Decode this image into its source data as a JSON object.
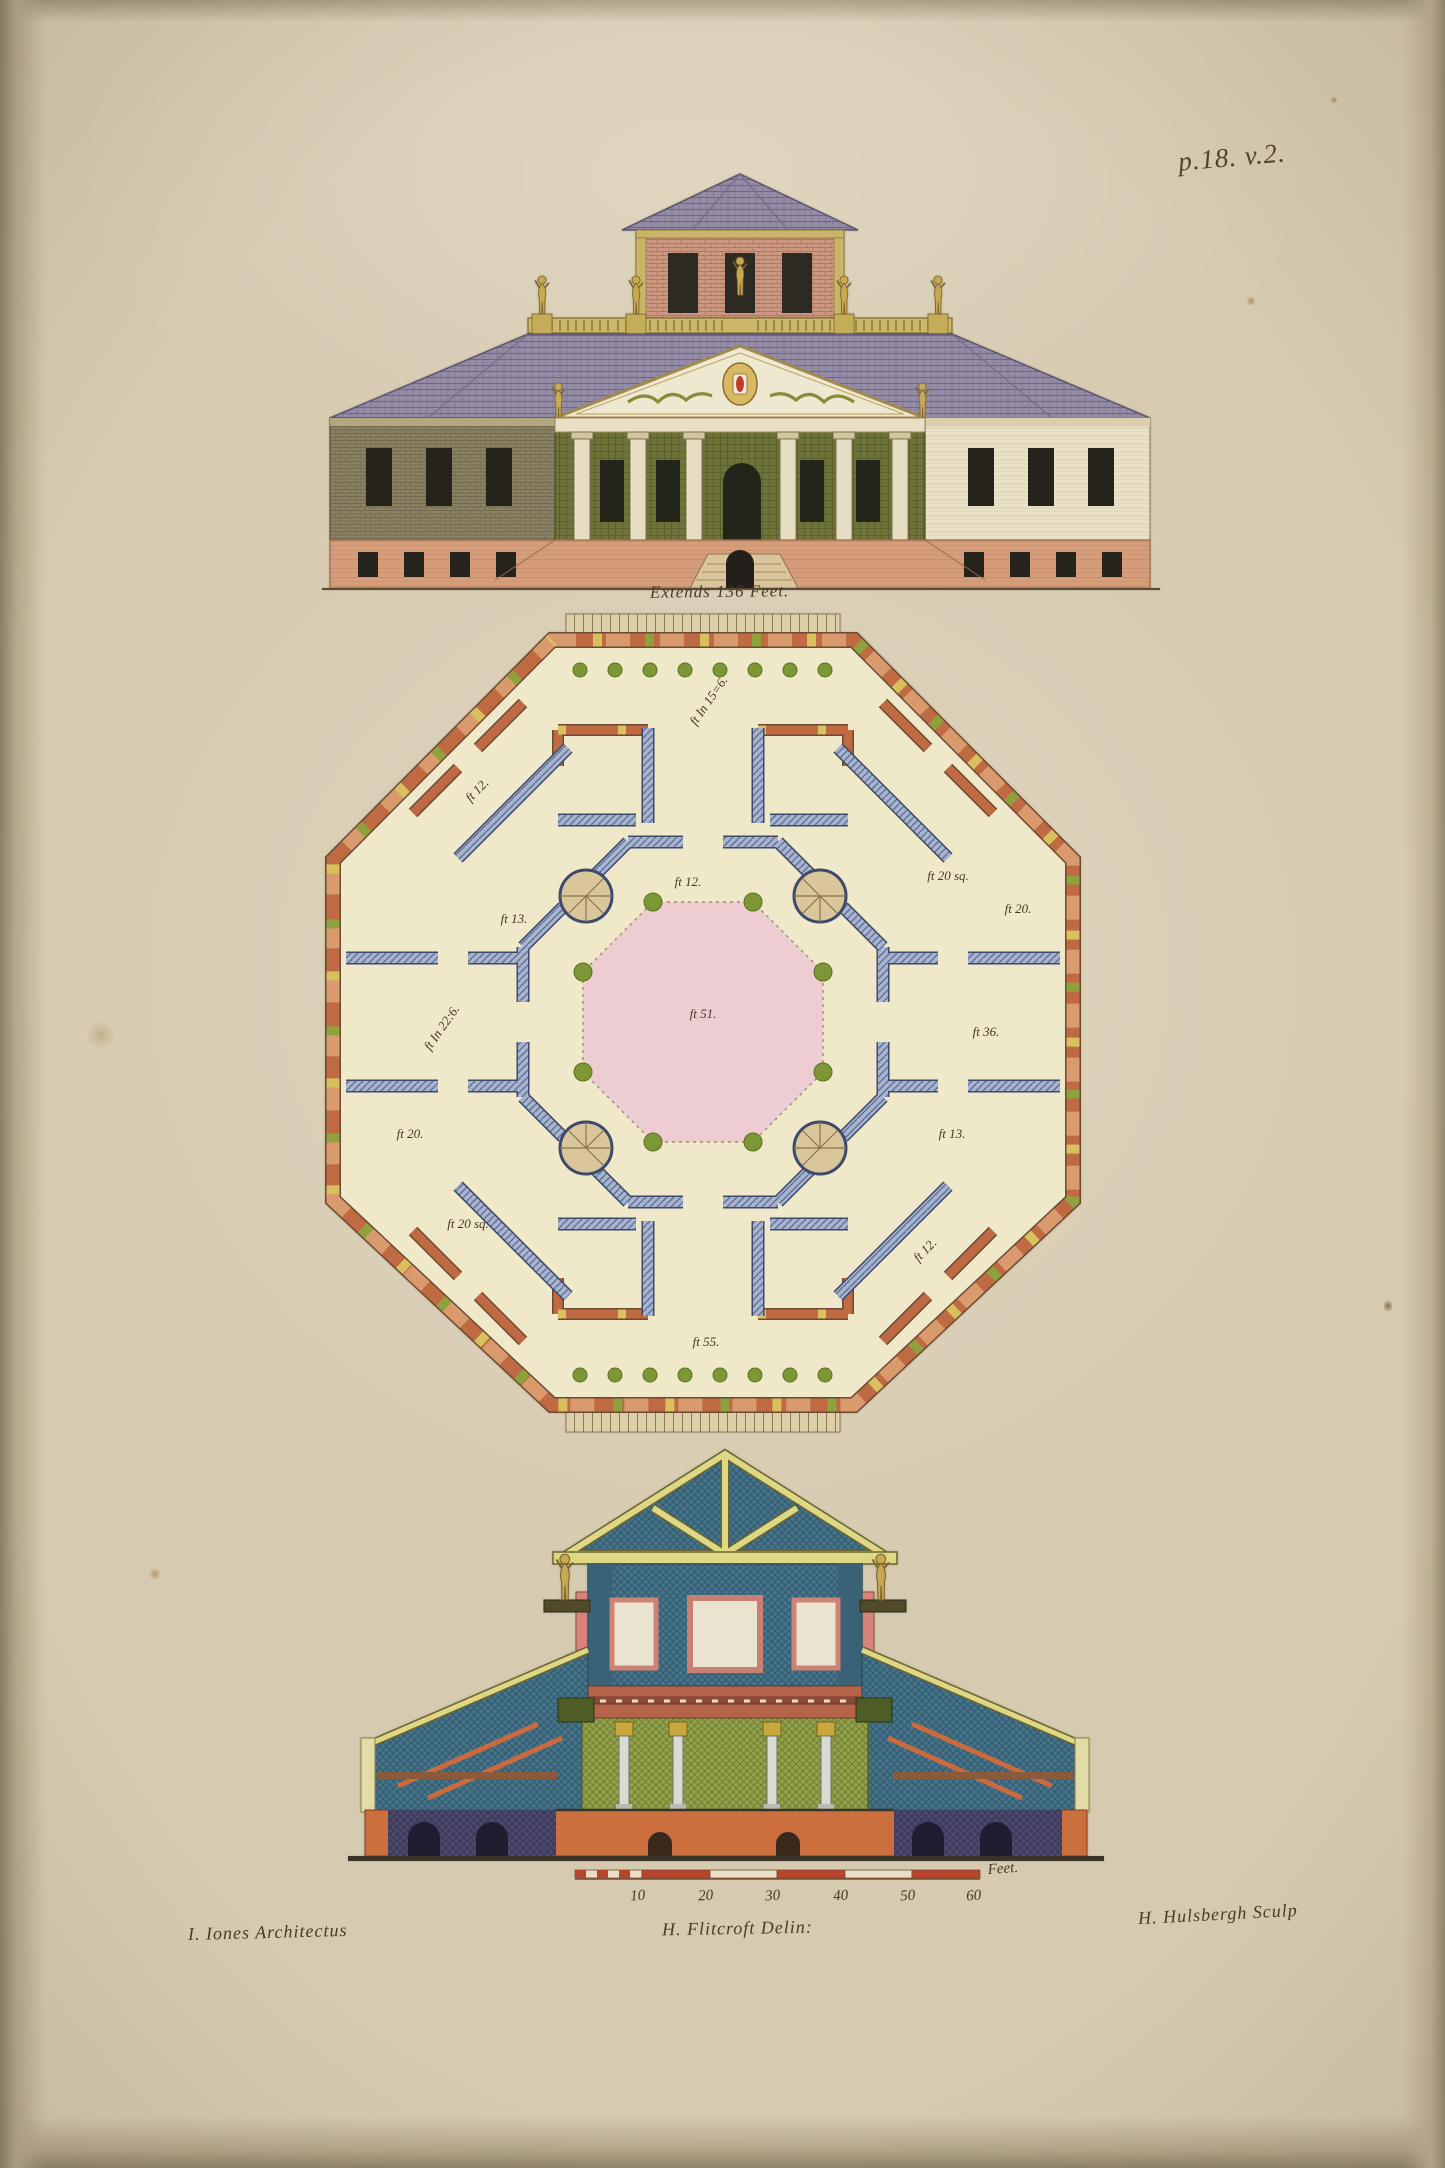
{
  "page": {
    "number": "p.18. v.2."
  },
  "elevation": {
    "caption": "Extends 136 Feet."
  },
  "plan": {
    "labels": [
      {
        "name": "north-vestibule",
        "text": "ft In 15=6."
      },
      {
        "name": "north-west-room",
        "text": "ft 12."
      },
      {
        "name": "north-east-room",
        "text": "ft 20 sq."
      },
      {
        "name": "northwest-gallery",
        "text": "ft 12."
      },
      {
        "name": "west-upper-room",
        "text": "ft 13."
      },
      {
        "name": "west-room",
        "text": "ft In 22:6."
      },
      {
        "name": "east-upper-room",
        "text": "ft 20."
      },
      {
        "name": "east-room",
        "text": "ft 36."
      },
      {
        "name": "central-hall",
        "text": "ft 51."
      },
      {
        "name": "west-lower-room",
        "text": "ft 20."
      },
      {
        "name": "east-lower-room",
        "text": "ft 13."
      },
      {
        "name": "south-west-room",
        "text": "ft 20 sq."
      },
      {
        "name": "southeast-gallery",
        "text": "ft 12."
      },
      {
        "name": "south-vestibule",
        "text": "ft 55."
      }
    ]
  },
  "scale_bar": {
    "ticks": [
      "10",
      "20",
      "30",
      "40",
      "50",
      "60"
    ],
    "unit": "Feet."
  },
  "credits": {
    "architect": "I. Iones Architectus",
    "draughtsman": "H. Flitcroft Delin:",
    "engraver": "H. Hulsbergh Sculp"
  },
  "colors": {
    "paper": "#d6cab0",
    "ink": "#4a3b28",
    "roof_slate": "#948ba5",
    "brick_pink": "#cb9780",
    "wing_olive": "#8a8162",
    "wing_cream": "#eae2c8",
    "base_salmon": "#d59d79",
    "portico_green": "#6e7339",
    "statue_gold": "#c9a94f",
    "plan_wall_blue": "#8b9ac0",
    "plan_wall_orange": "#bf6a42",
    "court_pink": "#eecdd2",
    "column_green": "#7d9636",
    "section_teal": "#47748a",
    "hall_green": "#93a24c",
    "basement_purple": "#4c486a",
    "basement_orange": "#cc6f3e"
  }
}
